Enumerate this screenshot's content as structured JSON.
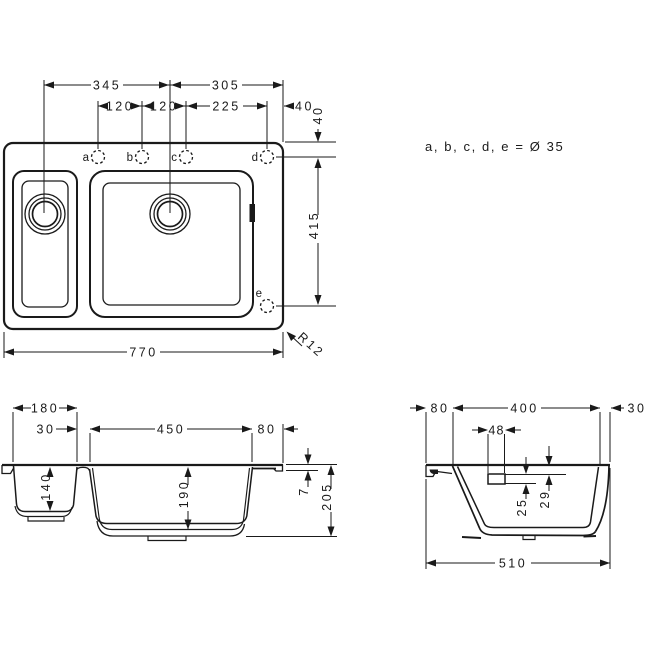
{
  "note": "a, b, c, d, e = Ø 35",
  "colors": {
    "line": "#1a1a1a",
    "background": "#ffffff"
  },
  "top_view": {
    "dim_345": "345",
    "dim_305": "305",
    "dim_120_left": "120",
    "dim_120_right": "120",
    "dim_225": "225",
    "dim_40_horizontal": "40",
    "dim_40_vertical": "40",
    "dim_415": "415",
    "dim_770": "770",
    "corner_radius": "R12",
    "hole_a": "a",
    "hole_b": "b",
    "hole_c": "c",
    "hole_d": "d",
    "hole_e": "e"
  },
  "front_section": {
    "dim_180": "180",
    "dim_30": "30",
    "dim_450": "450",
    "dim_80": "80",
    "dim_140": "140",
    "dim_190": "190",
    "dim_7": "7",
    "dim_205": "205"
  },
  "side_section": {
    "dim_80": "80",
    "dim_400": "400",
    "dim_30": "30",
    "dim_48": "48",
    "dim_29": "29",
    "dim_25": "25",
    "dim_510": "510"
  }
}
